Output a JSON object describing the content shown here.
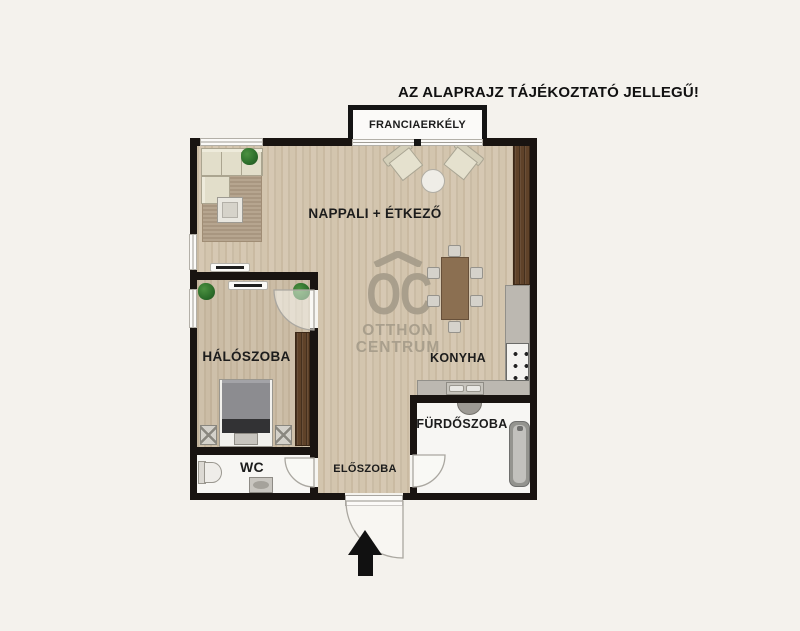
{
  "disclaimer": "AZ ALAPRAJZ TÁJÉKOZTATÓ JELLEGŰ!",
  "rooms": {
    "living": {
      "label": "NAPPALI + ÉTKEZŐ"
    },
    "balcony": {
      "label": "FRANCIAERKÉLY"
    },
    "bedroom": {
      "label": "HÁLÓSZOBA"
    },
    "kitchen": {
      "label": "KONYHA"
    },
    "bathroom": {
      "label": "FÜRDŐSZOBA"
    },
    "wc": {
      "label": "WC"
    },
    "hall": {
      "label": "ELŐSZOBA"
    }
  },
  "watermark": {
    "logo": "OC",
    "line1": "OTTHON",
    "line2": "CENTRUM"
  },
  "icons": {
    "entrance_arrow": "up-arrow",
    "watermark_roof": "chevron-roof"
  },
  "colors": {
    "background": "#f4f2ed",
    "wall": "#191411",
    "wood_floor": "#d3c5ae",
    "bedroom_floor": "#cbbca5",
    "wet_room_floor": "#f7f6f3",
    "cabinet_brown": "#5f4229",
    "counter_gray": "#bcb8b1",
    "watermark": "#a79d8b",
    "label_text": "#1c1c1c"
  }
}
